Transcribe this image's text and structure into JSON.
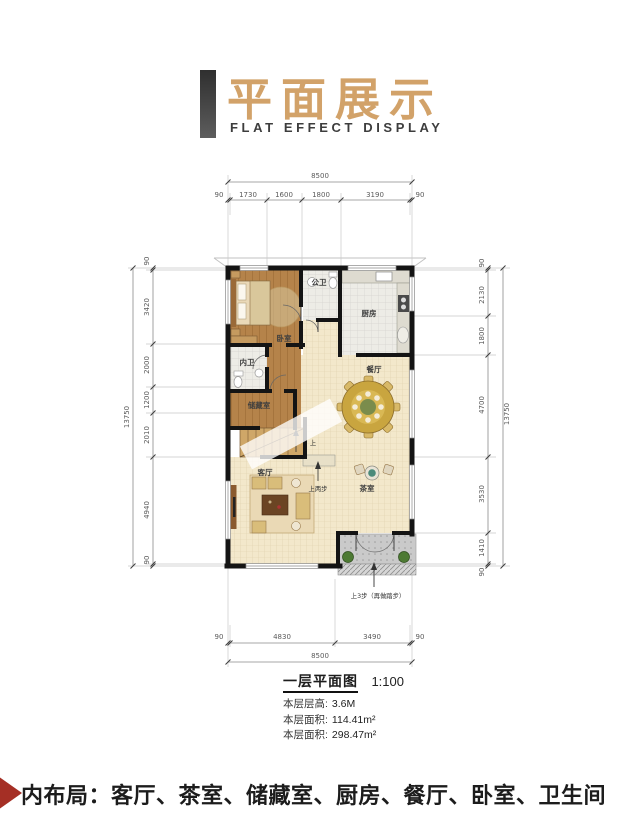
{
  "header": {
    "title": "平面展示",
    "subtitle": "FLAT EFFECT DISPLAY"
  },
  "plan": {
    "dims": {
      "top_total": "8500",
      "top": [
        "90",
        "1730",
        "1600",
        "1800",
        "3190",
        "90"
      ],
      "left_total": "13750",
      "left": [
        "90",
        "3420",
        "2000",
        "1200",
        "2010",
        "4940",
        "90"
      ],
      "right": [
        "90",
        "2130",
        "1800",
        "4700",
        "3530",
        "1410",
        "90"
      ],
      "right_total": "13750",
      "bottom": [
        "90",
        "4830",
        "3490",
        "90"
      ],
      "bottom_total": "8500"
    },
    "rooms": {
      "bedroom": "卧室",
      "public_bath": "公卫",
      "kitchen": "厨房",
      "ensuite_bath": "内卫",
      "storage": "储藏室",
      "dining": "餐厅",
      "living": "客厅",
      "tea": "茶室"
    },
    "annotations": {
      "stairs_up": "上",
      "step_up": "上两步",
      "entry_steps": "上3步（再做踏步）"
    }
  },
  "caption": {
    "title": "一层平面图",
    "scale": "1:100"
  },
  "info": [
    {
      "label": "本层层高:",
      "value": "3.6M"
    },
    {
      "label": "本层面积:",
      "value": "114.41m²"
    },
    {
      "label": "本层面积:",
      "value": "298.47m²"
    }
  ],
  "footer": {
    "text": "内布局：客厅、茶室、储藏室、厨房、餐厅、卧室、卫生间"
  },
  "colors": {
    "accent_tan": "#d2a269",
    "bar_gray": "#3d3d3d",
    "banner_red": "#a52f25",
    "wall_black": "#141414",
    "wood_floor": "#b5834a",
    "tile_cream": "#f3e8cb",
    "porch_gray": "#cacaca"
  }
}
